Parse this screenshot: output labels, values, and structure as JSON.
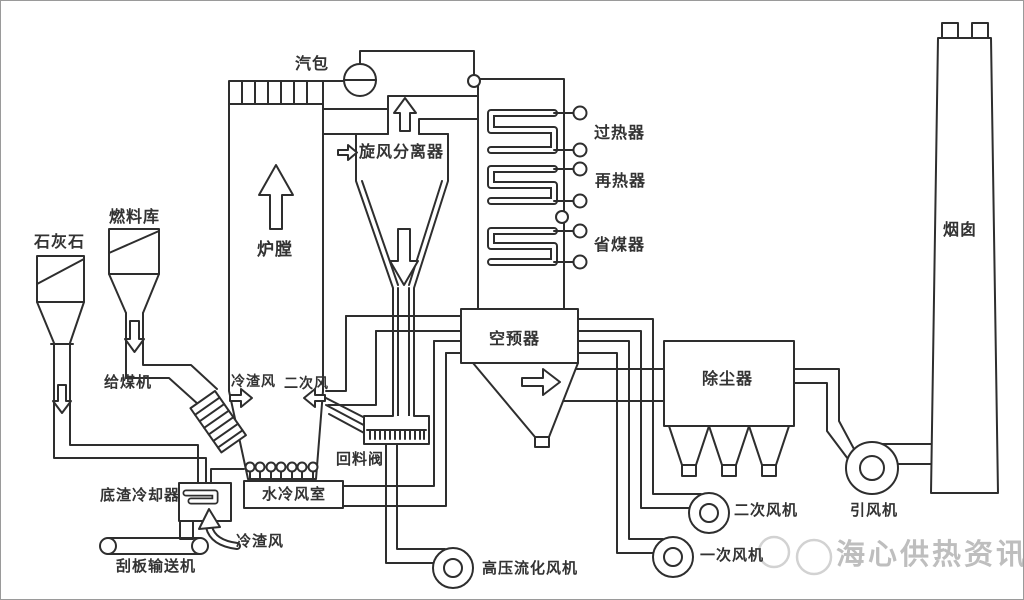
{
  "diagram": {
    "labels": {
      "steam_drum": "汽包",
      "cyclone_separator": "旋风分离器",
      "superheater": "过热器",
      "reheater": "再热器",
      "economizer": "省煤器",
      "furnace": "炉膛",
      "limestone": "石灰石",
      "fuel_bunker": "燃料库",
      "coal_feeder": "给煤机",
      "cold_slag_air_inlet": "冷渣风",
      "secondary_air_inlet": "二次风",
      "return_valve": "回料阀",
      "water_cooled_windbox": "水冷风室",
      "bottom_slag_cooler": "底渣冷却器",
      "scraper_conveyor": "刮板输送机",
      "cold_slag_air_duct": "冷渣风",
      "air_preheater": "空预器",
      "dust_collector": "除尘器",
      "hp_fluidizing_fan": "高压流化风机",
      "primary_air_fan": "一次风机",
      "secondary_air_fan": "二次风机",
      "induced_draft_fan": "引风机",
      "chimney": "烟囱"
    },
    "watermark": "海心供热资讯",
    "colors": {
      "line": "#2e2e2e",
      "label_text": "#333333",
      "watermark": "#969696",
      "background": "#ffffff"
    }
  }
}
